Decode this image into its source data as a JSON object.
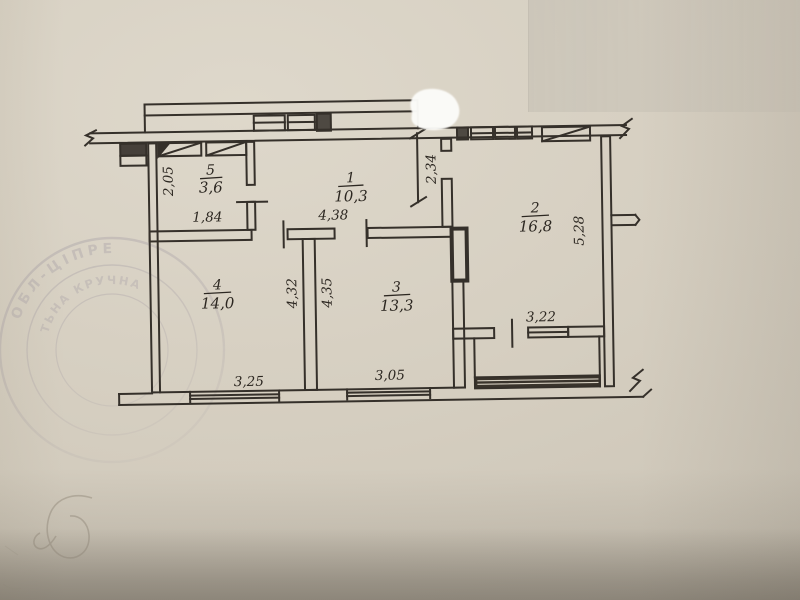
{
  "document": {
    "kind": "apartment floor plan photo",
    "decimal_style": "comma"
  },
  "plan": {
    "rooms": [
      {
        "number": "5",
        "area": "3,6"
      },
      {
        "number": "1",
        "area": "10,3"
      },
      {
        "number": "2",
        "area": "16,8"
      },
      {
        "number": "4",
        "area": "14,0"
      },
      {
        "number": "3",
        "area": "13,3"
      }
    ],
    "dimensions": [
      {
        "id": "room5-depth",
        "value": "2,05"
      },
      {
        "id": "room5-width",
        "value": "1,84"
      },
      {
        "id": "hall-length",
        "value": "4,38"
      },
      {
        "id": "hall-right-depth",
        "value": "2,34"
      },
      {
        "id": "room2-depth",
        "value": "5,28"
      },
      {
        "id": "room4-depth",
        "value": "4,32"
      },
      {
        "id": "room3-depth",
        "value": "4,35"
      },
      {
        "id": "room4-width",
        "value": "3,25"
      },
      {
        "id": "room3-width",
        "value": "3,05"
      },
      {
        "id": "balcony-opening",
        "value": "3,22"
      }
    ]
  },
  "stamp": {
    "arc_text_upper": "ОБЛ-ЦІПРЕ",
    "arc_text_lower": "ТЬНА КРУЧНА"
  },
  "colors": {
    "ink": "#35302a",
    "paper": "#d6cfc1",
    "stamp": "#6f6683",
    "whiteout": "#fcfcf9"
  }
}
